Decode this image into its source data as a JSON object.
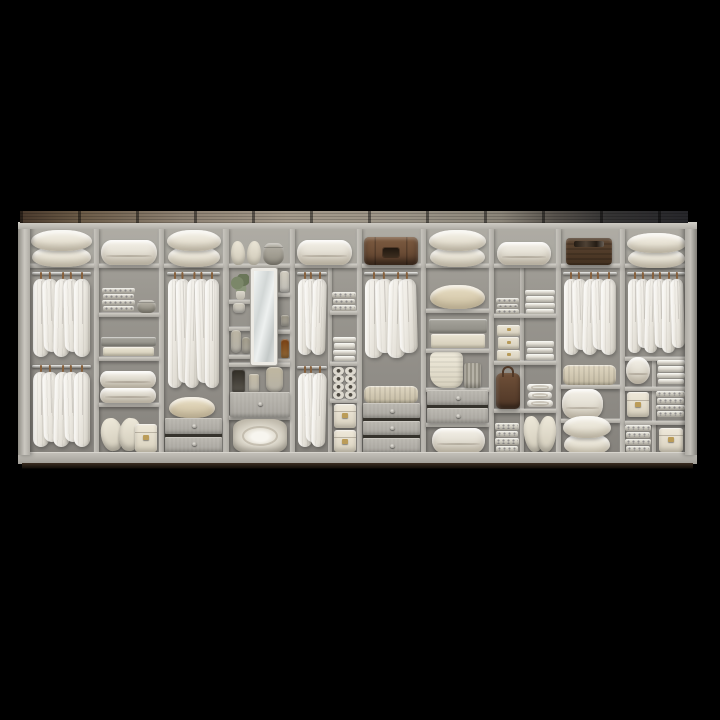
{
  "scene": {
    "description": "Wide modular open wardrobe unit photographed on a black background, filled with pillows, folded duvets, hanging white shirts, boxes and leather cases",
    "background": "#000000"
  },
  "palette": {
    "background": "#000000",
    "cabinet_frame": "#b5b2ab",
    "back_panel": "#908d87",
    "wood_beam": "#5a4634",
    "textiles": "#ece8dd",
    "leather": "#6b4e38",
    "mirror": "#e9edec",
    "floor_shadow": "#2d221a"
  },
  "frame": {
    "beam": [
      20,
      211,
      668,
      12
    ],
    "top_rail": [
      18,
      222,
      679,
      7
    ],
    "body": [
      29,
      228,
      657,
      226
    ],
    "cubby_band": [
      29,
      228,
      657,
      38
    ],
    "left_stile": [
      18,
      222,
      12,
      233
    ],
    "right_stile": [
      685,
      222,
      12,
      233
    ],
    "plinth": [
      18,
      452,
      679,
      11
    ],
    "floor_strip": [
      22,
      463,
      671,
      6
    ]
  },
  "dividers": [
    [
      94,
      229,
      5,
      224
    ],
    [
      159,
      229,
      5,
      224
    ],
    [
      223,
      229,
      6,
      224
    ],
    [
      290,
      229,
      5,
      224
    ],
    [
      357,
      229,
      5,
      224
    ],
    [
      421,
      229,
      5,
      224
    ],
    [
      489,
      229,
      5,
      224
    ],
    [
      556,
      229,
      5,
      224
    ],
    [
      620,
      229,
      5,
      224
    ]
  ],
  "sub_dividers": [
    [
      328,
      268,
      4,
      185
    ],
    [
      520,
      268,
      4,
      185
    ],
    [
      652,
      357,
      4,
      96
    ]
  ],
  "shelves": [
    [
      29,
      264,
      65
    ],
    [
      99,
      264,
      60
    ],
    [
      164,
      264,
      59
    ],
    [
      229,
      264,
      61
    ],
    [
      295,
      264,
      62
    ],
    [
      362,
      264,
      59
    ],
    [
      426,
      264,
      63
    ],
    [
      494,
      264,
      62
    ],
    [
      561,
      264,
      59
    ],
    [
      625,
      264,
      63
    ],
    [
      99,
      313,
      60
    ],
    [
      99,
      357,
      60
    ],
    [
      99,
      403,
      60
    ],
    [
      229,
      300,
      22
    ],
    [
      229,
      327,
      22
    ],
    [
      229,
      355,
      22
    ],
    [
      277,
      293,
      13
    ],
    [
      277,
      330,
      13
    ],
    [
      277,
      359,
      13
    ],
    [
      229,
      363,
      61
    ],
    [
      229,
      416,
      61
    ],
    [
      330,
      311,
      27
    ],
    [
      330,
      362,
      27
    ],
    [
      330,
      399,
      27
    ],
    [
      426,
      309,
      63
    ],
    [
      426,
      349,
      63
    ],
    [
      426,
      388,
      63
    ],
    [
      426,
      423,
      63
    ],
    [
      494,
      314,
      62
    ],
    [
      494,
      361,
      62
    ],
    [
      494,
      409,
      62
    ],
    [
      561,
      385,
      59
    ],
    [
      561,
      419,
      59
    ],
    [
      625,
      357,
      63
    ],
    [
      625,
      387,
      63
    ],
    [
      625,
      421,
      63
    ]
  ],
  "items": [
    {
      "name": "pillow-stack",
      "type": "pillows",
      "rect": [
        31,
        233,
        61,
        32
      ],
      "count": 2
    },
    {
      "name": "folded-duvet",
      "type": "duvet",
      "rect": [
        101,
        240,
        56,
        25
      ]
    },
    {
      "name": "pillow-stack",
      "type": "pillows",
      "rect": [
        167,
        233,
        54,
        32
      ],
      "count": 2
    },
    {
      "name": "cushion-pair",
      "type": "cushions",
      "rect": [
        231,
        241,
        30,
        24
      ]
    },
    {
      "name": "round-basket",
      "type": "basket",
      "rect": [
        263,
        243,
        21,
        22
      ]
    },
    {
      "name": "folded-duvet",
      "type": "duvet",
      "rect": [
        297,
        240,
        55,
        25
      ]
    },
    {
      "name": "leather-suitcase",
      "type": "suitcase",
      "rect": [
        364,
        237,
        54,
        28
      ]
    },
    {
      "name": "pillow-stack",
      "type": "pillows",
      "rect": [
        429,
        233,
        57,
        32
      ],
      "count": 2
    },
    {
      "name": "folded-duvet",
      "type": "duvet",
      "rect": [
        497,
        242,
        54,
        23
      ]
    },
    {
      "name": "vintage-leather-case",
      "type": "darkcase",
      "rect": [
        566,
        238,
        46,
        27
      ]
    },
    {
      "name": "pillow-stack",
      "type": "pillows",
      "rect": [
        627,
        236,
        59,
        30
      ],
      "count": 2
    },
    {
      "name": "hanging-shirts",
      "type": "rack",
      "rect": [
        31,
        272,
        61,
        89
      ],
      "count": 5
    },
    {
      "name": "hanging-shirts",
      "type": "rack",
      "rect": [
        31,
        365,
        61,
        86
      ],
      "count": 5
    },
    {
      "name": "hanging-shirts",
      "type": "rack",
      "rect": [
        166,
        272,
        55,
        120
      ],
      "count": 5
    },
    {
      "name": "hanging-shirts",
      "type": "rack",
      "rect": [
        296,
        272,
        32,
        87
      ],
      "count": 3
    },
    {
      "name": "hanging-shirts",
      "type": "rack",
      "rect": [
        296,
        366,
        32,
        85
      ],
      "count": 3
    },
    {
      "name": "hanging-shirts",
      "type": "rack",
      "rect": [
        363,
        272,
        56,
        90
      ],
      "count": 4
    },
    {
      "name": "hanging-shirts",
      "type": "rack",
      "rect": [
        562,
        272,
        56,
        87
      ],
      "count": 5
    },
    {
      "name": "hanging-shirts",
      "type": "rack",
      "rect": [
        626,
        272,
        60,
        85
      ],
      "count": 6
    },
    {
      "name": "folded-towels",
      "type": "stack",
      "rect": [
        102,
        287,
        33,
        24
      ],
      "count": 4,
      "style": "pattern"
    },
    {
      "name": "round-bin",
      "type": "basket",
      "rect": [
        137,
        300,
        19,
        13
      ]
    },
    {
      "name": "folded-blankets",
      "type": "stack",
      "rect": [
        101,
        336,
        55,
        20
      ],
      "count": 2,
      "style": "graycream"
    },
    {
      "name": "folded-duvet",
      "type": "duvet",
      "rect": [
        100,
        371,
        56,
        17
      ]
    },
    {
      "name": "folded-duvet",
      "type": "duvet",
      "rect": [
        100,
        388,
        56,
        15
      ]
    },
    {
      "name": "leaning-pillows",
      "type": "leanpillows",
      "rect": [
        101,
        414,
        40,
        38
      ]
    },
    {
      "name": "storage-box",
      "type": "box",
      "rect": [
        135,
        424,
        22,
        28
      ]
    },
    {
      "name": "accent-pillow",
      "type": "pillowbeige",
      "rect": [
        169,
        397,
        46,
        21
      ]
    },
    {
      "name": "drawers",
      "type": "drawers",
      "rect": [
        165,
        418,
        57,
        34
      ],
      "count": 2
    },
    {
      "name": "potted-plant",
      "type": "plant",
      "rect": [
        231,
        274,
        18,
        26
      ]
    },
    {
      "name": "ceramic-pot",
      "type": "deco",
      "rect": [
        233,
        303,
        12,
        10
      ],
      "color": "#e6e3da",
      "radius": "3px 3px 4px 4px"
    },
    {
      "name": "vase",
      "type": "deco",
      "rect": [
        231,
        330,
        10,
        23
      ],
      "color": "#dbd7cc",
      "radius": "4px 4px 5px 5px"
    },
    {
      "name": "vase",
      "type": "deco",
      "rect": [
        242,
        337,
        8,
        16
      ],
      "color": "#ccc8bc",
      "radius": "3px"
    },
    {
      "name": "dressing-mirror",
      "type": "mirror",
      "rect": [
        251,
        268,
        26,
        97
      ]
    },
    {
      "name": "spray-bottle",
      "type": "deco",
      "rect": [
        280,
        271,
        9,
        21
      ],
      "color": "#e8e5dd",
      "radius": "3px 3px 2px 2px"
    },
    {
      "name": "cosmetic-jar",
      "type": "deco",
      "rect": [
        281,
        315,
        8,
        11
      ],
      "color": "#c7c3b8",
      "radius": "2px"
    },
    {
      "name": "amber-bottle",
      "type": "deco",
      "rect": [
        281,
        339,
        8,
        19
      ],
      "color": "#b08045",
      "radius": "3px 3px 2px 2px"
    },
    {
      "name": "pump-bottles",
      "type": "deco",
      "rect": [
        232,
        369,
        13,
        23
      ],
      "color": "#6e6960",
      "radius": "3px 3px 2px 2px"
    },
    {
      "name": "candle",
      "type": "deco",
      "rect": [
        249,
        374,
        10,
        18
      ],
      "color": "#e0dbce",
      "radius": "2px"
    },
    {
      "name": "woven-vase",
      "type": "deco",
      "rect": [
        266,
        367,
        17,
        25
      ],
      "color": "#ddd8ca",
      "radius": "5px 5px 7px 7px"
    },
    {
      "name": "vanity-drawer",
      "type": "drawers",
      "rect": [
        230,
        392,
        60,
        25
      ],
      "count": 1
    },
    {
      "name": "rolled-duvet",
      "type": "roll",
      "rect": [
        233,
        419,
        54,
        34
      ]
    },
    {
      "name": "folded-towels",
      "type": "stack",
      "rect": [
        332,
        291,
        24,
        20
      ],
      "count": 3,
      "style": "pattern"
    },
    {
      "name": "folded-towels",
      "type": "stack",
      "rect": [
        333,
        336,
        23,
        25
      ],
      "count": 4,
      "style": "white"
    },
    {
      "name": "rolled-accessories",
      "type": "hatgrid",
      "rect": [
        333,
        367,
        23,
        32
      ]
    },
    {
      "name": "storage-boxes",
      "type": "boxstack2",
      "rect": [
        334,
        404,
        22,
        48
      ]
    },
    {
      "name": "knit-blanket",
      "type": "stack",
      "rect": [
        364,
        385,
        54,
        18
      ],
      "count": 1,
      "style": "knit"
    },
    {
      "name": "drawers",
      "type": "drawers",
      "rect": [
        363,
        403,
        57,
        50
      ],
      "count": 3
    },
    {
      "name": "pillow",
      "type": "pillowbeige",
      "rect": [
        430,
        285,
        55,
        24
      ]
    },
    {
      "name": "folded-blankets",
      "type": "stack",
      "rect": [
        429,
        318,
        58,
        30
      ],
      "count": 2,
      "style": "graycream"
    },
    {
      "name": "draped-throw",
      "type": "throw",
      "rect": [
        430,
        352,
        33,
        36
      ]
    },
    {
      "name": "ribbed-bin",
      "type": "bin",
      "rect": [
        464,
        363,
        17,
        25
      ]
    },
    {
      "name": "drawers",
      "type": "drawers",
      "rect": [
        427,
        390,
        61,
        33
      ],
      "count": 2
    },
    {
      "name": "folded-duvet",
      "type": "duvet",
      "rect": [
        432,
        428,
        53,
        25
      ]
    },
    {
      "name": "folded-towels",
      "type": "stack",
      "rect": [
        496,
        297,
        23,
        17
      ],
      "count": 3,
      "style": "pattern"
    },
    {
      "name": "storage-boxes",
      "type": "stack",
      "rect": [
        497,
        324,
        23,
        37
      ],
      "count": 3,
      "style": "box"
    },
    {
      "name": "leather-bag",
      "type": "bag",
      "rect": [
        496,
        373,
        24,
        36
      ]
    },
    {
      "name": "folded-towels",
      "type": "stack",
      "rect": [
        495,
        422,
        24,
        30
      ],
      "count": 4,
      "style": "pattern"
    },
    {
      "name": "folded-towels",
      "type": "stack",
      "rect": [
        525,
        289,
        30,
        25
      ],
      "count": 4,
      "style": "white"
    },
    {
      "name": "folded-sheets",
      "type": "stack",
      "rect": [
        526,
        340,
        28,
        20
      ],
      "count": 3,
      "style": "white"
    },
    {
      "name": "rolled-towels",
      "type": "stack",
      "rect": [
        527,
        383,
        26,
        24
      ],
      "count": 3,
      "style": "roll"
    },
    {
      "name": "leaning-pillows",
      "type": "leanpillows",
      "rect": [
        524,
        412,
        32,
        41
      ]
    },
    {
      "name": "knit-blanket",
      "type": "stack",
      "rect": [
        563,
        364,
        53,
        21
      ],
      "count": 1,
      "style": "knit"
    },
    {
      "name": "folded-duvet",
      "type": "duvet",
      "rect": [
        562,
        389,
        41,
        30
      ]
    },
    {
      "name": "pillow-stack",
      "type": "pillows",
      "rect": [
        563,
        419,
        48,
        34
      ],
      "count": 2
    },
    {
      "name": "rolled-duvet",
      "type": "duvet",
      "rect": [
        626,
        357,
        24,
        27
      ]
    },
    {
      "name": "storage-box",
      "type": "box",
      "rect": [
        627,
        392,
        22,
        25
      ]
    },
    {
      "name": "folded-towels",
      "type": "stack",
      "rect": [
        625,
        424,
        26,
        28
      ],
      "count": 4,
      "style": "pattern"
    },
    {
      "name": "folded-towels",
      "type": "stack",
      "rect": [
        657,
        359,
        28,
        25
      ],
      "count": 4,
      "style": "white"
    },
    {
      "name": "folded-towels",
      "type": "stack",
      "rect": [
        656,
        390,
        29,
        27
      ],
      "count": 4,
      "style": "pattern"
    },
    {
      "name": "storage-box",
      "type": "box",
      "rect": [
        659,
        428,
        24,
        24
      ]
    }
  ]
}
